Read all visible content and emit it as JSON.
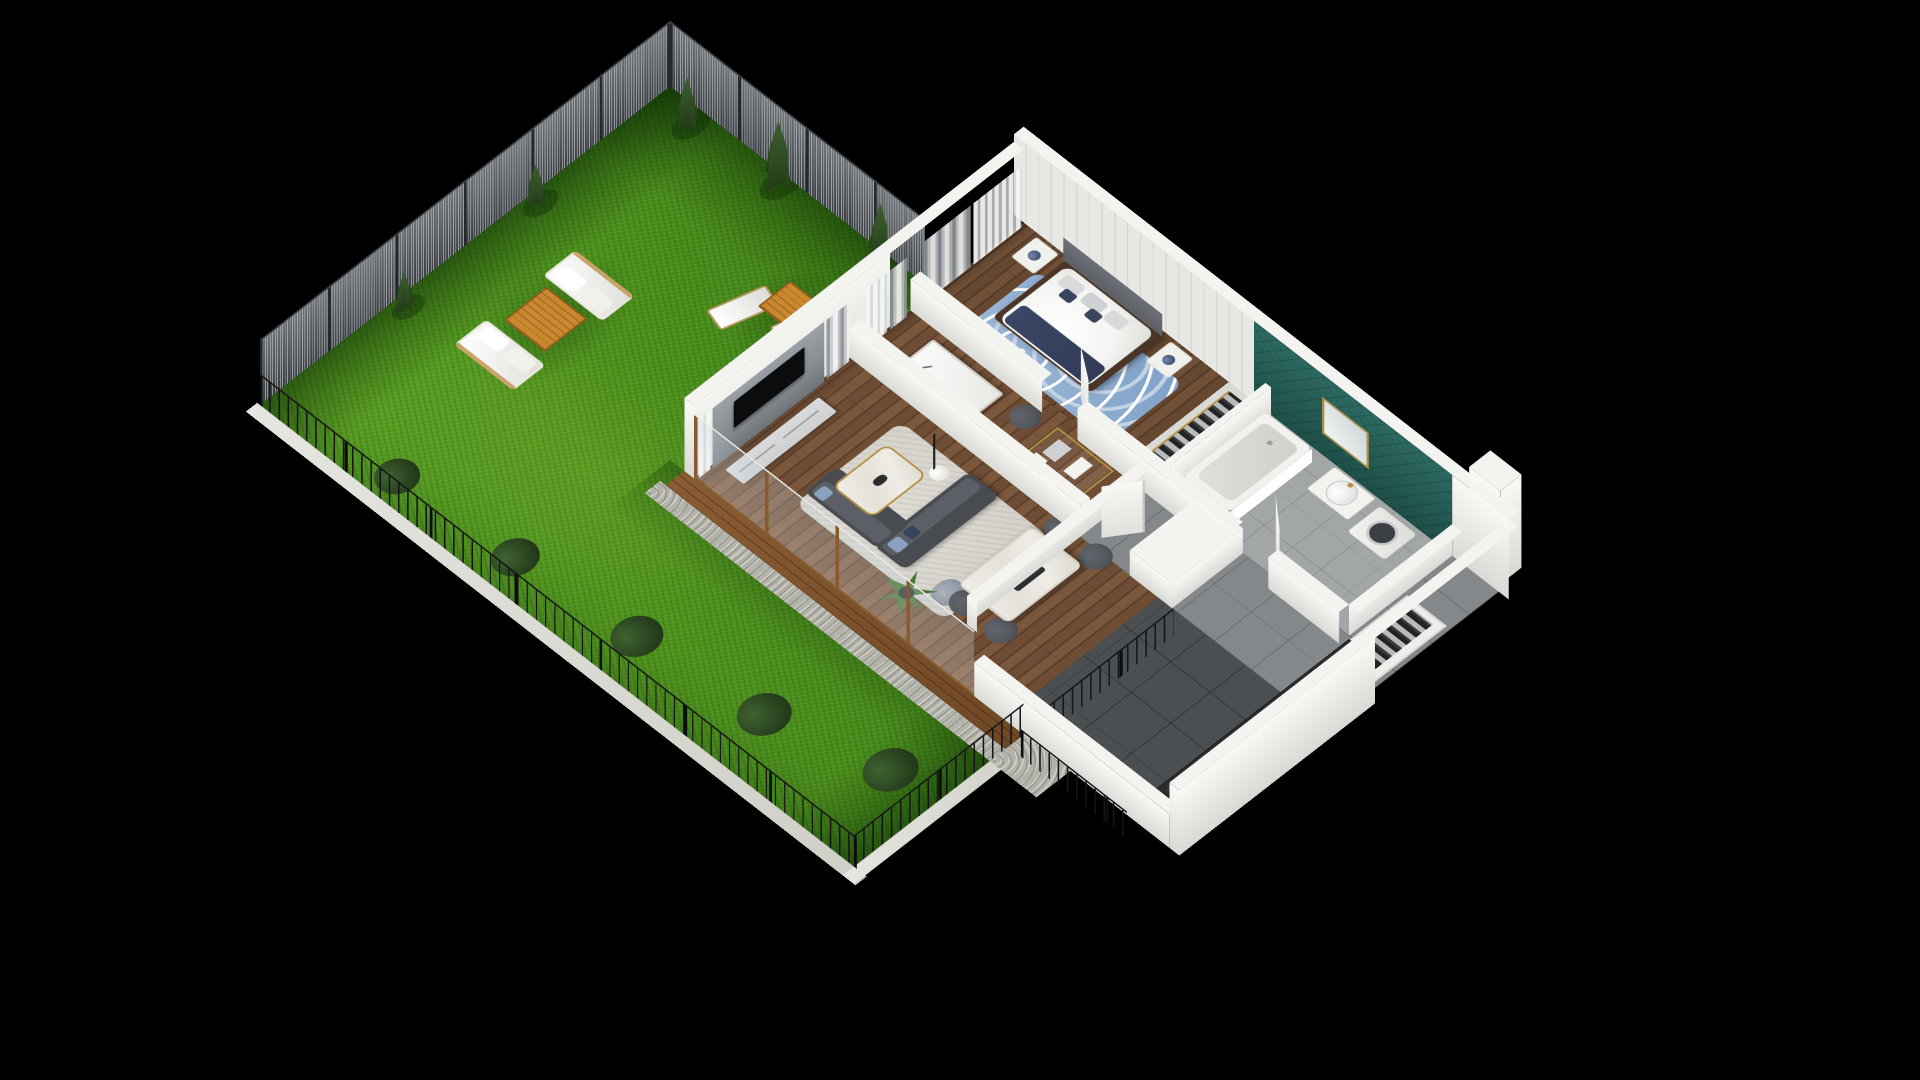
{
  "scene": {
    "description": "3D isometric cutaway floor plan of a one-bedroom apartment with a large private fenced garden, rendered on a black background",
    "projection": "isometric",
    "background": "#000000"
  },
  "colors": {
    "bg": "#000000",
    "grass1": "#5ea426",
    "grass2": "#47891b",
    "grass3": "#3c7a12",
    "bush": "#22381a",
    "tree1": "#3e6030",
    "tree2": "#243d18",
    "curb": "#cfcfc8",
    "meshPanel": "#51565a",
    "meshWire": "#aab1b6",
    "meshPost": "#26292c",
    "picket": "#141517",
    "wallTop": "#f3f3f0",
    "wallBright": "#f8f8f5",
    "wallShade": "#d9d9d5",
    "wallIn": "#ededea",
    "plank1": "#e7e7e4",
    "plank2": "#d8d8d4",
    "glass": "rgba(196,212,222,0.28)",
    "frameWood": "#8a5a2e",
    "deck1": "#8a5c33",
    "deck2": "#6f4826",
    "gravel": "#b3b3ac",
    "woodFloor1": "#6f4d34",
    "woodFloor2": "#5e402a",
    "tile": "#85888b",
    "tileDark": "#4b4f52",
    "bathFloor": "#a3a6a6",
    "teal1": "#2d6a63",
    "teal2": "#1f4f49",
    "gold": "#b5913f",
    "curtain1": "#f1f1ee",
    "curtain2": "#8e9196",
    "panelGray": "#878c91",
    "tv": "#0b0c0e",
    "console": "#cdcfd1",
    "sofa1": "#484b50",
    "sofa2": "#5c6066",
    "pillowBlue": "#8ba1c0",
    "pillowNavy": "#39445f",
    "rugGray": "#d2cfc8",
    "rugBlue1": "#7ea1c8",
    "rugBlue2": "#c3d2e4",
    "marble": "#efece6",
    "chair": "#53565b",
    "woodTable": "#c9872e",
    "duvet": "#f4f4f2",
    "navy": "#323c58",
    "headboard": "#6d7076",
    "bedframe": "#4a3526",
    "nightstand": "#f0f0ed",
    "lampNavy": "#2e3a5c",
    "counter": "#232527",
    "counterEdge": "#17181a",
    "steel": "#9aa0a4",
    "tub": "#f1f1ee",
    "tubIn": "#dfe0dc",
    "washerDoor": "#3b3e42",
    "white": "#f6f6f3",
    "doorWhite": "#f4f4f1",
    "plant": "#3a6b2c",
    "pot": "#2e2f31",
    "shadow": "rgba(0,20,0,0.30)"
  },
  "garden": {
    "lawn": "grass",
    "fences": {
      "rear": "tall steel mesh panel fence",
      "side": "tall steel mesh panel fence",
      "front": "low black metal picket fence on concrete curb"
    },
    "trees": {
      "conifers": 5,
      "bushes": 5
    },
    "furniture": {
      "sofa_set": {
        "sofas": 2,
        "upholstery": "white",
        "coffee_table": "orange wood"
      },
      "sun_loungers": {
        "count": 2,
        "color": "white",
        "side_table": "orange wood"
      }
    }
  },
  "house": {
    "style": "cutaway white walls, open roof",
    "rooms": [
      {
        "name": "living-room",
        "furniture": [
          "tv-accent-wall",
          "tv",
          "tv-console",
          "sectional-sofa",
          "marble-coffee-table",
          "floor-lamp",
          "area-rug",
          "pouf",
          "potted-palm"
        ]
      },
      {
        "name": "dining-area",
        "furniture": [
          "marble-dining-table",
          "dining-chairs-x4"
        ]
      },
      {
        "name": "kitchen",
        "furniture": [
          "dark-counter",
          "cooktop",
          "sink-gold-tap",
          "cutting-board",
          "coffee-machine"
        ]
      },
      {
        "name": "study-nook",
        "furniture": [
          "white-desk",
          "desk-lamp",
          "chair",
          "gold-frame-shelf"
        ]
      },
      {
        "name": "hallway",
        "furniture": [
          "white-doors-ajar-x3",
          "gray-tile-floor"
        ]
      },
      {
        "name": "bedroom",
        "furniture": [
          "double-bed-navy-throw",
          "floral-pillows",
          "nightstands-x2",
          "table-lamps",
          "blue-area-rug",
          "curtains",
          "headboard"
        ]
      },
      {
        "name": "wardrobe",
        "furniture": [
          "hanging-clothes-rows-x2",
          "gold-rails"
        ]
      },
      {
        "name": "bathroom",
        "furniture": [
          "bathtub",
          "vanity-round-sink",
          "gold-mirror",
          "washing-machine",
          "teal-tile-wall"
        ]
      },
      {
        "name": "terrace",
        "furniture": [
          "wood-deck",
          "glass-railing",
          "gravel-border"
        ]
      }
    ]
  }
}
